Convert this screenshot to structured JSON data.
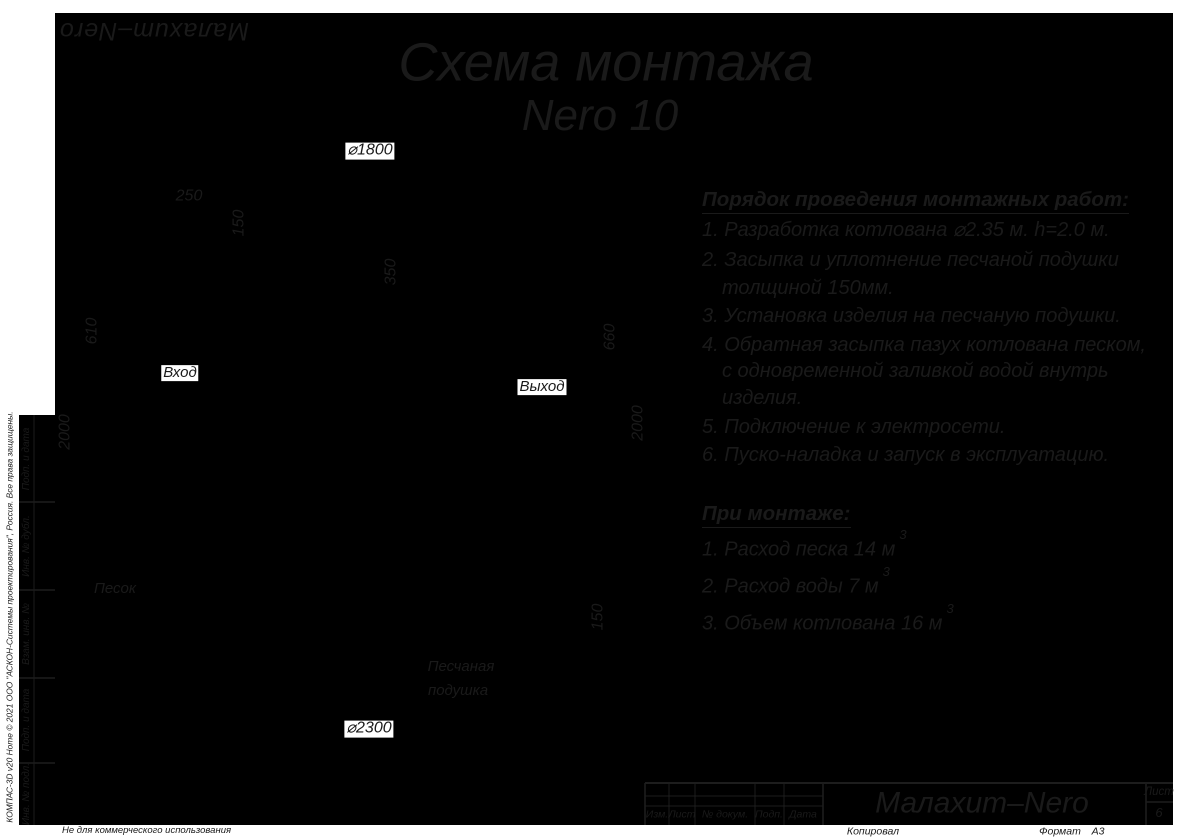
{
  "logo": "Малахит–Nero",
  "title": {
    "line1": "Схема монтажа",
    "line2": "Nero 10"
  },
  "instructions": {
    "header": "Порядок проведения монтажных работ:",
    "lines": [
      "1. Разработка котлована ⌀2.35 м. h=2.0 м.",
      "2. Засыпка и уплотнение песчаной подушки",
      "толщиной 150мм.",
      "3. Установка изделия на песчаную подушки.",
      "4. Обратная засыпка пазух котлована песком,",
      "с одновременной заливкой водой внутрь",
      "изделия.",
      "5. Подключение к электросети.",
      "6. Пуско-наладка и запуск в эксплуатацию."
    ]
  },
  "montage": {
    "header": "При монтаже:",
    "items": [
      {
        "text": "1. Расход песка 14 м",
        "sup": "3"
      },
      {
        "text": "2. Расход воды 7 м",
        "sup": "3"
      },
      {
        "text": "3. Объем котлована 16 м",
        "sup": "3"
      }
    ]
  },
  "dimensions": {
    "tank_diameter": "⌀1800",
    "pit_diameter": "⌀2300",
    "side_gap": "250",
    "lid_height": "150",
    "plate_depth": "350",
    "inlet_depth": "610",
    "outlet_depth": "660",
    "pit_depth_left": "2000",
    "pit_depth_right": "2000",
    "cushion_thickness": "150"
  },
  "labels": {
    "inlet": "Вход",
    "outlet": "Выход",
    "sand": "Песок",
    "cushion_line1": "Песчаная",
    "cushion_line2": "подушка"
  },
  "title_block": {
    "cols": [
      "Изм.",
      "Лист",
      "№ докум.",
      "Подп.",
      "Дата"
    ],
    "company": "Малахит–Nero",
    "sheet_label": "Лист",
    "sheet_number": "6",
    "copied": "Копировал",
    "format_label": "Формат",
    "format_value": "А3"
  },
  "side": {
    "vendor": "КОМПАС-3D v20 Home © 2021 ООО \"АСКОН-Системы проектирования\", Россия. Все права защищены.",
    "stamps": [
      "Подп. и дата",
      "Инв. № дубл.",
      "Взам. инв. №",
      "Подп. и дата",
      "Инв. № подл."
    ],
    "note": "Не для коммерческого использования"
  }
}
